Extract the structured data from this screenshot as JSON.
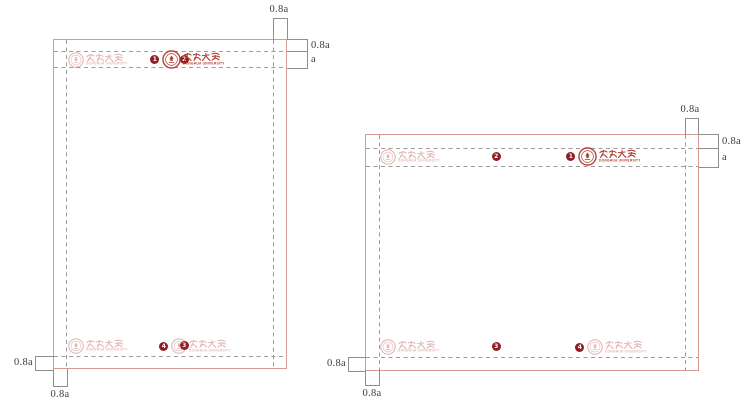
{
  "colors": {
    "frame_border": "#d79b92",
    "dashed_line": "#9b9b9b",
    "measure_line": "#8f8f8f",
    "label_text": "#3d3d3d",
    "logo_red": "#b23a2e",
    "badge_bg": "#8e1d24",
    "badge_text": "#ffffff"
  },
  "logo": {
    "chinese_wordmark": "東華大學",
    "subtitle": "DONGHUA UNIVERSITY"
  },
  "figures": [
    {
      "name": "portrait-layout-template",
      "dims": {
        "right_margin": "0.8a",
        "top_margin": "0.8a",
        "band_height": "a",
        "bottom_margin": "0.8a",
        "left_margin": "0.8a"
      },
      "logos": [
        {
          "badge": "2",
          "style": "faded"
        },
        {
          "badge": "1",
          "style": "solid"
        },
        {
          "badge": "3",
          "style": "faded"
        },
        {
          "badge": "4",
          "style": "faded"
        }
      ]
    },
    {
      "name": "landscape-layout-template",
      "dims": {
        "right_margin": "0.8a",
        "top_margin": "0.8a",
        "band_height": "a",
        "bottom_margin": "0.8a",
        "left_margin": "0.8a"
      },
      "logos": [
        {
          "badge": "2",
          "style": "faded"
        },
        {
          "badge": "1",
          "style": "solid"
        },
        {
          "badge": "3",
          "style": "faded"
        },
        {
          "badge": "4",
          "style": "faded"
        }
      ]
    }
  ]
}
